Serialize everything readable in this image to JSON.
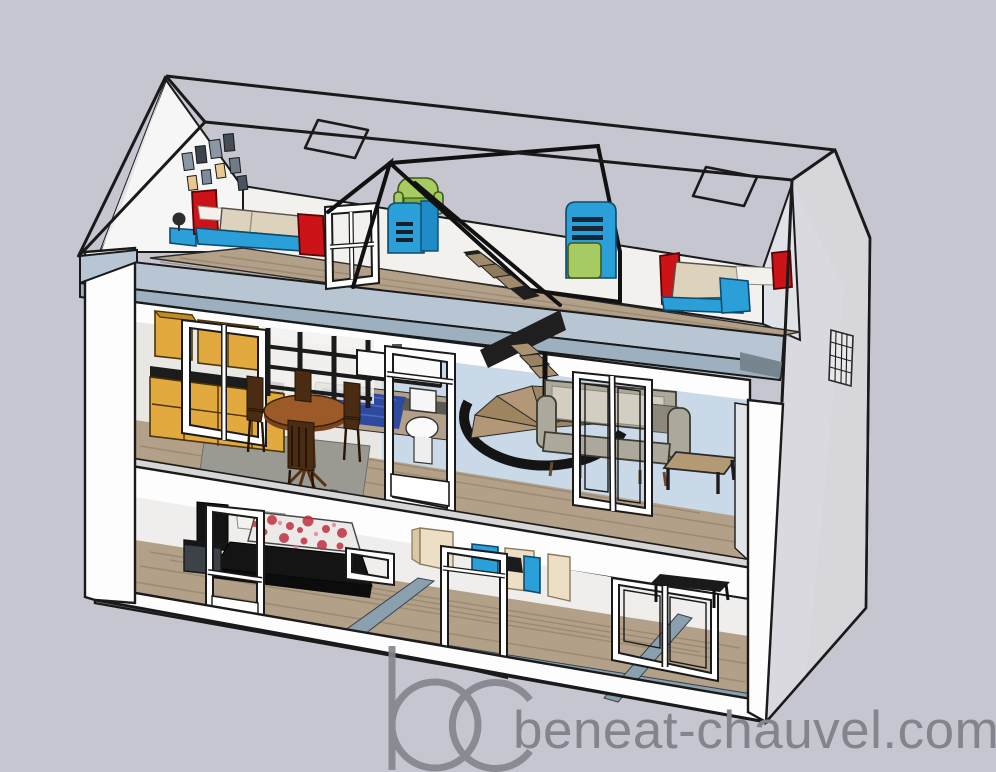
{
  "canvas": {
    "width": 996,
    "height": 772
  },
  "watermark": {
    "logo_text": "bc",
    "site_text": "beneat-chauvel.com"
  },
  "palette": {
    "background": "#c6c6d1",
    "outline": "#1a1a1a",
    "wall_white": "#fdfdfd",
    "wall_interior": "#f2f1ee",
    "gable_gray": "#d6d6db",
    "slab_blue": "#b7c6d2",
    "slab_blue_dark": "#9db0bf",
    "slab_blue_deep": "#76868f",
    "floor_strip_blue": "#8ba0ae",
    "back_wall_blue": "#c9d9e7",
    "wood_floor": "#b3a089",
    "wood_dark": "#8f7c64",
    "kitchen_yellow": "#e2a93e",
    "kitchen_yellow_dark": "#c08c28",
    "counter_black": "#1c1c1c",
    "table_brown": "#9c5a28",
    "chair_brown": "#4a2c12",
    "rug_blue": "#2d4aa0",
    "carpet_gray": "#9a9a93",
    "sofa_gray": "#aca89b",
    "sofa_cushion": "#d2cec1",
    "bed_red": "#cc1418",
    "furniture_blue": "#2b9fd8",
    "furniture_green": "#a7cb63",
    "duvet_beige": "#ddd3bd",
    "floral_red": "#c03040",
    "bed_black": "#141414",
    "partition_beige": "#ecdfc6",
    "watermark_gray": "#84848c"
  },
  "scene": {
    "type": "3d-dollhouse-cutaway-render",
    "floors": [
      {
        "name": "attic",
        "items": [
          "single-bed-left",
          "single-bed-right",
          "green-armchair",
          "blue-cabinet",
          "wardrobe-green-door",
          "dormer-window-frame",
          "picture-frames",
          "stair-railing",
          "skylights",
          "desk-fan"
        ]
      },
      {
        "name": "middle-floor",
        "items": [
          "kitchen-cabinets",
          "kitchen-window",
          "open-shelving",
          "dining-table",
          "dining-chairs",
          "blue-rug",
          "wall-vanity",
          "toilet",
          "toilet-door-frame",
          "spiral-staircase",
          "sofa",
          "french-door-frame",
          "side-table"
        ]
      },
      {
        "name": "ground-floor",
        "items": [
          "double-bed-floral",
          "nightstand",
          "tall-window-frame",
          "picture-frame",
          "partition-walls",
          "shower-fixtures",
          "door-frame",
          "double-window",
          "black-desk"
        ]
      }
    ]
  }
}
